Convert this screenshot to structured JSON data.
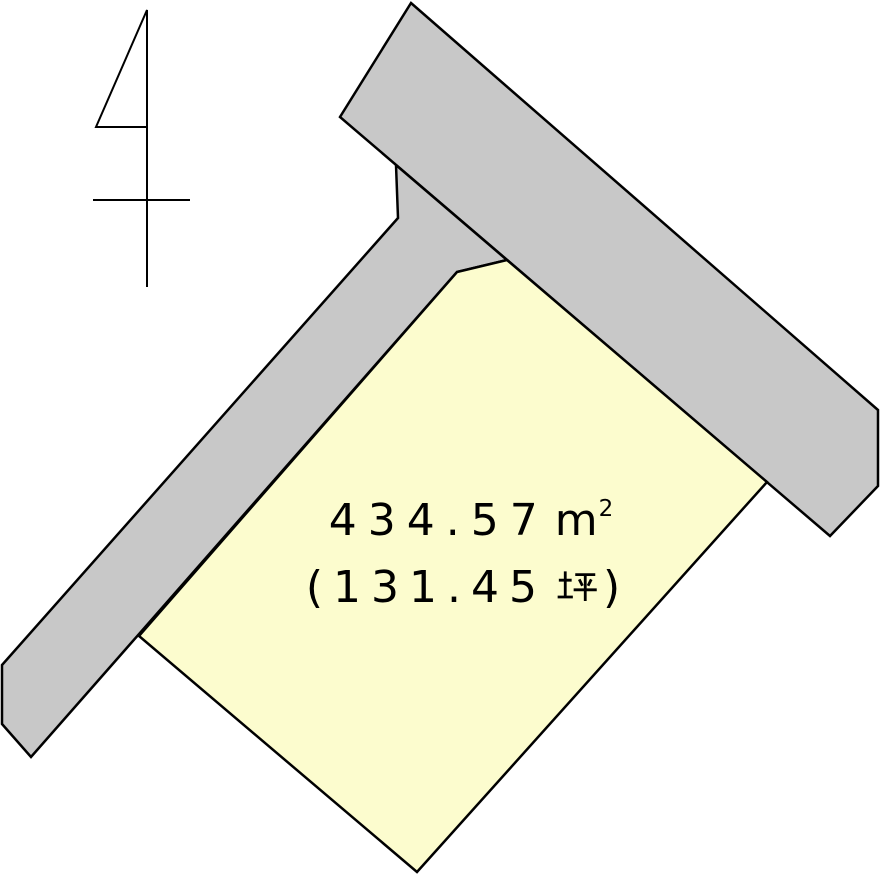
{
  "labels": {
    "area_display": "434.57",
    "area_unit_base": "m",
    "area_unit_exponent": "2",
    "area_full_text_as_shown": "４３４.５７㎡",
    "tsubo_prefix": "(131.45",
    "tsubo_unit": "坪",
    "tsubo_suffix": ")",
    "tsubo_full_text_as_shown": "（１３１.４５坪）"
  },
  "colors": {
    "background": "#ffffff",
    "road_fill": "#c8c8c8",
    "plot_fill": "#fcfcce",
    "outline": "#000000",
    "text": "#000000"
  },
  "diagram": {
    "canvas": {
      "width": 881,
      "height": 877
    },
    "outline_width": 2.5,
    "shapes": [
      {
        "name": "road-upper",
        "fill": "road_fill",
        "points": [
          [
            411,
            3
          ],
          [
            878,
            410
          ],
          [
            878,
            486
          ],
          [
            830,
            536
          ],
          [
            340,
            117
          ]
        ]
      },
      {
        "name": "road-left",
        "fill": "road_fill",
        "points": [
          [
            396,
            165
          ],
          [
            398,
            218
          ],
          [
            2,
            665
          ],
          [
            2,
            724
          ],
          [
            31,
            757
          ],
          [
            457,
            272
          ],
          [
            507,
            260
          ]
        ]
      },
      {
        "name": "land-plot",
        "fill": "plot_fill",
        "points": [
          [
            457,
            272
          ],
          [
            507,
            260
          ],
          [
            767,
            482
          ],
          [
            417,
            872
          ],
          [
            139,
            636
          ]
        ]
      }
    ],
    "north_arrow": {
      "stroke_width": 2,
      "lines": [
        [
          147,
          10,
          147,
          287
        ],
        [
          93,
          200,
          190,
          200
        ]
      ],
      "triangle": [
        [
          147,
          10
        ],
        [
          96,
          127
        ],
        [
          147,
          127
        ]
      ]
    }
  }
}
